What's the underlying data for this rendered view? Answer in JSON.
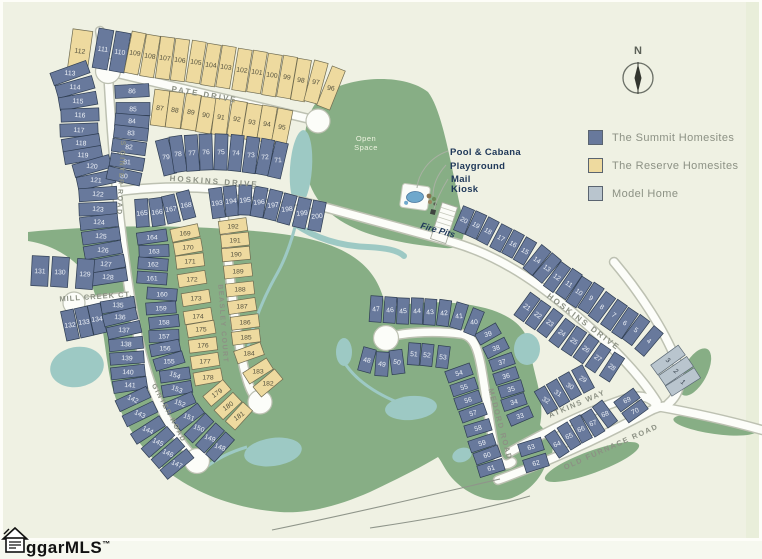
{
  "colors": {
    "bg": "#eff1e3",
    "page": "#fdfdf8",
    "edge_strip": "#e9eeda",
    "green": "#87ae85",
    "water": "#9dc9c4",
    "road_fill": "#fcfdf9",
    "road_casing": "#bdc1b2",
    "road_edge_line": "#8f958a",
    "summit": "#68799c",
    "summit_stroke": "#2e3d52",
    "reserve": "#eeda9f",
    "reserve_stroke": "#6f6b50",
    "model": "#b9c5ce",
    "model_stroke": "#5b6975",
    "num_summit": "#eef2f8",
    "num_reserve": "#55523f",
    "num_model": "#3c4752",
    "street_text": "#8c9184",
    "navy": "#20395a",
    "open_space_text": "#edf2df",
    "pool_water": "#6fa8cc"
  },
  "legend": {
    "items": [
      {
        "key": "summit",
        "label": "The Summit Homesites",
        "color": "#68799c"
      },
      {
        "key": "reserve",
        "label": "The Reserve Homesites",
        "color": "#eeda9f"
      },
      {
        "key": "model",
        "label": "Model Home",
        "color": "#b9c5ce"
      }
    ]
  },
  "compass": {
    "north_label": "N",
    "cx": 638,
    "cy": 78,
    "r": 15
  },
  "watermark": {
    "text": "ggarMLS",
    "tm": "™"
  },
  "open_space_label": {
    "line1": "Open",
    "line2": "Space",
    "x": 366,
    "y": 141
  },
  "amenity_labels": [
    {
      "text": "Pool & Cabana",
      "x": 450,
      "y": 155
    },
    {
      "text": "Playground",
      "x": 450,
      "y": 169
    },
    {
      "text": "Mail",
      "x": 451,
      "y": 182
    },
    {
      "text": "Kiosk",
      "x": 451,
      "y": 192
    }
  ],
  "fire_pits_label": {
    "text": "Fire Pits",
    "x": 437,
    "y": 233,
    "rot": 16
  },
  "street_labels": [
    {
      "text": "PATE DRIVE",
      "x": 204,
      "y": 97,
      "rot": 10,
      "size": 8,
      "ls": 2
    },
    {
      "text": "S GINTER ROAD",
      "x": 119,
      "y": 178,
      "rot": 93,
      "size": 7,
      "ls": 1.5
    },
    {
      "text": "HOSKINS DRIVE",
      "x": 214,
      "y": 184,
      "rot": 4,
      "size": 8,
      "ls": 2
    },
    {
      "text": "MILL CREEK CT.",
      "x": 96,
      "y": 299,
      "rot": -4,
      "size": 7.5,
      "ls": 1
    },
    {
      "text": "BEASLEY COURT",
      "x": 221,
      "y": 324,
      "rot": 86,
      "size": 7,
      "ls": 1.5
    },
    {
      "text": "GINTER ROAD",
      "x": 167,
      "y": 414,
      "rot": 62,
      "size": 7,
      "ls": 1.5
    },
    {
      "text": "HOSKINS DRIVE",
      "x": 582,
      "y": 324,
      "rot": 37,
      "size": 8,
      "ls": 2
    },
    {
      "text": "MEDORD ROAD",
      "x": 498,
      "y": 425,
      "rot": 75,
      "size": 7.5,
      "ls": 1.5
    },
    {
      "text": "ATKINS WAY",
      "x": 578,
      "y": 406,
      "rot": -23,
      "size": 7.5,
      "ls": 1.5
    },
    {
      "text": "OLD FURNACE ROAD",
      "x": 612,
      "y": 449,
      "rot": -24,
      "size": 7.5,
      "ls": 1.5
    }
  ],
  "lot_strips": [
    {
      "t": "R",
      "d": 42,
      "w": 20,
      "tr": 8,
      "a": 8,
      "n": [
        112
      ],
      "p": [
        [
          80,
          51
        ]
      ]
    },
    {
      "t": "S",
      "d": 40,
      "w": 15,
      "tr": 8,
      "n": [
        111,
        110
      ],
      "p": [
        [
          103,
          49
        ],
        [
          120,
          52
        ]
      ]
    },
    {
      "t": "R",
      "d": 42,
      "w": 14,
      "tr": 8,
      "n": [
        109,
        108,
        107,
        106,
        105,
        104,
        103,
        102,
        101,
        100,
        99,
        98,
        97,
        96
      ],
      "p": [
        [
          135,
          53
        ],
        [
          150,
          56
        ],
        [
          165,
          58
        ],
        [
          180,
          60
        ],
        [
          196,
          62
        ],
        [
          211,
          65
        ],
        [
          226,
          67
        ],
        [
          242,
          70
        ],
        [
          257,
          72
        ],
        [
          272,
          75
        ],
        [
          287,
          77
        ],
        [
          301,
          80
        ],
        [
          316,
          82
        ],
        [
          331,
          88
        ]
      ]
    },
    {
      "t": "R",
      "d": 36,
      "w": 15,
      "tr": 8,
      "n": [
        87,
        88,
        89,
        90,
        91,
        92,
        93,
        94,
        95
      ],
      "p": [
        [
          160,
          108
        ],
        [
          175,
          110
        ],
        [
          191,
          112
        ],
        [
          206,
          115
        ],
        [
          221,
          117
        ],
        [
          237,
          119
        ],
        [
          252,
          122
        ],
        [
          267,
          124
        ],
        [
          282,
          127
        ]
      ]
    },
    {
      "t": "S",
      "d": 38,
      "w": 13,
      "tr": 4,
      "n": [
        113,
        114,
        115,
        116,
        117,
        118,
        119
      ],
      "p": [
        [
          70,
          73
        ],
        [
          75,
          87
        ],
        [
          78,
          101
        ],
        [
          80,
          115
        ],
        [
          79,
          130
        ],
        [
          81,
          143
        ],
        [
          83,
          155
        ]
      ]
    },
    {
      "t": "S",
      "d": 38,
      "w": 13,
      "tr": 4,
      "n": [
        120,
        121,
        122,
        123,
        124,
        125,
        126,
        127,
        128
      ],
      "p": [
        [
          92,
          166
        ],
        [
          96,
          180
        ],
        [
          98,
          194
        ],
        [
          98,
          209
        ],
        [
          99,
          222
        ],
        [
          101,
          236
        ],
        [
          103,
          250
        ],
        [
          106,
          264
        ],
        [
          108,
          277
        ]
      ]
    },
    {
      "t": "S",
      "d": 30,
      "w": 17,
      "tr": 2,
      "n": [
        131,
        130,
        129
      ],
      "p": [
        [
          40,
          271
        ],
        [
          60,
          272
        ],
        [
          85,
          274
        ]
      ]
    },
    {
      "t": "S",
      "d": 30,
      "w": 13,
      "tr": -6,
      "n": [
        132,
        133,
        134
      ],
      "p": [
        [
          70,
          325
        ],
        [
          84,
          322
        ],
        [
          97,
          319
        ]
      ]
    },
    {
      "t": "S",
      "d": 34,
      "w": 12,
      "tr": 3,
      "n": [
        135,
        136,
        137,
        138,
        139,
        140,
        141
      ],
      "p": [
        [
          118,
          305
        ],
        [
          120,
          317
        ],
        [
          124,
          330
        ],
        [
          126,
          344
        ],
        [
          127,
          358
        ],
        [
          128,
          372
        ],
        [
          130,
          385
        ]
      ]
    },
    {
      "t": "S",
      "d": 34,
      "w": 12,
      "tr": 25,
      "n": [
        142,
        143,
        144,
        145,
        146,
        147
      ],
      "p": [
        [
          133,
          399
        ],
        [
          140,
          414
        ],
        [
          148,
          430
        ],
        [
          158,
          442
        ],
        [
          168,
          453
        ],
        [
          177,
          464
        ]
      ]
    },
    {
      "t": "S",
      "d": 34,
      "w": 13,
      "tr": 3,
      "n": [
        86,
        85,
        84,
        83,
        82,
        81,
        80
      ],
      "p": [
        [
          132,
          91
        ],
        [
          133,
          109
        ],
        [
          132,
          121
        ],
        [
          131,
          133
        ],
        [
          129,
          147
        ],
        [
          127,
          162
        ],
        [
          124,
          176
        ]
      ]
    },
    {
      "t": "S",
      "d": 36,
      "w": 13,
      "tr": -3,
      "n": [
        79,
        78,
        77,
        76,
        75,
        74,
        73,
        72,
        71
      ],
      "p": [
        [
          166,
          157
        ],
        [
          178,
          154
        ],
        [
          192,
          153
        ],
        [
          206,
          152
        ],
        [
          221,
          152
        ],
        [
          236,
          153
        ],
        [
          251,
          155
        ],
        [
          265,
          157
        ],
        [
          278,
          160
        ]
      ]
    },
    {
      "t": "S",
      "d": 28,
      "w": 13,
      "tr": -6,
      "n": [
        165,
        166,
        167,
        168
      ],
      "p": [
        [
          142,
          213
        ],
        [
          157,
          212
        ],
        [
          171,
          209
        ],
        [
          186,
          205
        ]
      ]
    },
    {
      "t": "S",
      "d": 30,
      "w": 12,
      "tr": 0,
      "n": [
        164,
        163,
        162,
        161
      ],
      "p": [
        [
          152,
          237
        ],
        [
          154,
          251
        ],
        [
          153,
          264
        ],
        [
          152,
          278
        ]
      ]
    },
    {
      "t": "S",
      "d": 30,
      "w": 12,
      "tr": 0,
      "n": [
        160,
        159,
        158,
        157,
        156,
        155
      ],
      "p": [
        [
          162,
          294
        ],
        [
          161,
          308
        ],
        [
          164,
          322
        ],
        [
          164,
          336
        ],
        [
          165,
          348
        ],
        [
          169,
          361
        ]
      ]
    },
    {
      "t": "S",
      "d": 30,
      "w": 12,
      "tr": 20,
      "n": [
        154,
        153,
        152,
        151,
        150,
        149,
        148
      ],
      "p": [
        [
          175,
          375
        ],
        [
          177,
          389
        ],
        [
          180,
          403
        ],
        [
          189,
          417
        ],
        [
          199,
          428
        ],
        [
          210,
          438
        ],
        [
          220,
          447
        ]
      ]
    },
    {
      "t": "R",
      "d": 28,
      "w": 13,
      "tr": 0,
      "n": [
        169,
        170,
        171,
        172,
        173,
        174,
        175,
        176,
        177,
        178
      ],
      "p": [
        [
          185,
          233
        ],
        [
          188,
          247
        ],
        [
          190,
          261
        ],
        [
          192,
          279
        ],
        [
          196,
          298
        ],
        [
          198,
          316
        ],
        [
          201,
          329
        ],
        [
          203,
          345
        ],
        [
          205,
          361
        ],
        [
          208,
          377
        ]
      ]
    },
    {
      "t": "R",
      "d": 26,
      "w": 13,
      "tr": -35,
      "n": [
        179,
        180,
        181
      ],
      "p": [
        [
          217,
          393
        ],
        [
          228,
          406
        ],
        [
          239,
          416
        ]
      ]
    },
    {
      "t": "R",
      "d": 28,
      "w": 13,
      "tr": 0,
      "n": [
        192,
        191,
        190,
        189,
        188,
        187,
        186,
        185,
        184,
        183,
        182
      ],
      "p": [
        [
          233,
          226
        ],
        [
          235,
          240
        ],
        [
          236,
          254
        ],
        [
          238,
          271
        ],
        [
          240,
          289
        ],
        [
          242,
          306
        ],
        [
          245,
          322
        ],
        [
          246,
          337
        ],
        [
          249,
          353
        ],
        [
          258,
          371
        ],
        [
          268,
          383
        ]
      ]
    },
    {
      "t": "S",
      "d": 30,
      "w": 13,
      "tr": -5,
      "n": [
        193,
        194,
        195,
        196,
        197,
        198,
        199,
        200
      ],
      "p": [
        [
          217,
          203
        ],
        [
          231,
          201
        ],
        [
          245,
          200
        ],
        [
          259,
          202
        ],
        [
          273,
          205
        ],
        [
          287,
          209
        ],
        [
          302,
          213
        ],
        [
          317,
          216
        ]
      ]
    },
    {
      "t": "S",
      "d": 26,
      "w": 12,
      "tr": 30,
      "n": [
        20,
        19,
        18,
        17,
        16,
        15
      ],
      "p": [
        [
          464,
          220
        ],
        [
          476,
          225
        ],
        [
          488,
          231
        ],
        [
          501,
          238
        ],
        [
          513,
          244
        ],
        [
          525,
          251
        ]
      ]
    },
    {
      "t": "S",
      "d": 30,
      "w": 12,
      "tr": 35,
      "n": [
        14,
        13,
        12,
        11,
        10,
        9,
        8,
        7,
        6,
        5,
        4
      ],
      "p": [
        [
          537,
          260
        ],
        [
          547,
          268
        ],
        [
          557,
          277
        ],
        [
          569,
          284
        ],
        [
          579,
          292
        ],
        [
          591,
          298
        ],
        [
          602,
          307
        ],
        [
          614,
          315
        ],
        [
          625,
          323
        ],
        [
          636,
          330
        ],
        [
          649,
          341
        ]
      ]
    },
    {
      "t": "M",
      "d": 34,
      "w": 12,
      "tr": 35,
      "n": [
        3,
        2,
        1
      ],
      "p": [
        [
          668,
          360
        ],
        [
          676,
          371
        ],
        [
          683,
          382
        ]
      ]
    },
    {
      "t": "S",
      "d": 28,
      "w": 12,
      "tr": 35,
      "n": [
        21,
        22,
        23,
        24,
        25,
        26,
        27,
        28
      ],
      "p": [
        [
          527,
          307
        ],
        [
          538,
          315
        ],
        [
          550,
          323
        ],
        [
          562,
          333
        ],
        [
          574,
          341
        ],
        [
          586,
          349
        ],
        [
          598,
          358
        ],
        [
          612,
          367
        ]
      ]
    },
    {
      "t": "S",
      "d": 26,
      "w": 12,
      "tr": 30,
      "n": [
        29,
        30,
        31,
        32
      ],
      "p": [
        [
          583,
          379
        ],
        [
          570,
          386
        ],
        [
          558,
          393
        ],
        [
          546,
          400
        ]
      ]
    },
    {
      "t": "S",
      "d": 24,
      "w": 12,
      "tr": -15,
      "n": [
        39,
        38,
        37,
        36,
        35,
        34,
        33
      ],
      "p": [
        [
          488,
          334
        ],
        [
          496,
          348
        ],
        [
          502,
          362
        ],
        [
          506,
          376
        ],
        [
          511,
          389
        ],
        [
          514,
          402
        ],
        [
          520,
          416
        ]
      ]
    },
    {
      "t": "S",
      "d": 26,
      "w": 12,
      "tr": -5,
      "n": [
        47,
        46,
        45,
        44,
        43,
        42,
        41,
        40
      ],
      "p": [
        [
          376,
          309
        ],
        [
          390,
          310
        ],
        [
          403,
          311
        ],
        [
          417,
          311
        ],
        [
          430,
          312
        ],
        [
          444,
          313
        ],
        [
          459,
          316
        ],
        [
          474,
          322
        ]
      ]
    },
    {
      "t": "S",
      "d": 24,
      "w": 13,
      "tr": 10,
      "n": [
        48,
        49,
        50
      ],
      "p": [
        [
          367,
          360
        ],
        [
          382,
          364
        ],
        [
          397,
          362
        ]
      ]
    },
    {
      "t": "S",
      "d": 22,
      "w": 12,
      "tr": 5,
      "n": [
        51,
        52,
        53
      ],
      "p": [
        [
          414,
          354
        ],
        [
          427,
          355
        ],
        [
          443,
          357
        ]
      ]
    },
    {
      "t": "S",
      "d": 26,
      "w": 12,
      "tr": -15,
      "n": [
        54,
        55,
        56,
        57,
        58,
        59,
        60,
        61
      ],
      "p": [
        [
          459,
          373
        ],
        [
          464,
          387
        ],
        [
          468,
          400
        ],
        [
          473,
          413
        ],
        [
          478,
          428
        ],
        [
          482,
          443
        ],
        [
          487,
          455
        ],
        [
          491,
          468
        ]
      ]
    },
    {
      "t": "S",
      "d": 24,
      "w": 13,
      "tr": -15,
      "n": [
        63,
        62
      ],
      "p": [
        [
          531,
          447
        ],
        [
          536,
          463
        ]
      ]
    },
    {
      "t": "S",
      "d": 26,
      "w": 12,
      "tr": -20,
      "n": [
        64,
        65,
        66,
        67,
        68
      ],
      "p": [
        [
          557,
          444
        ],
        [
          569,
          436
        ],
        [
          581,
          429
        ],
        [
          593,
          423
        ],
        [
          605,
          414
        ]
      ]
    },
    {
      "t": "S",
      "d": 24,
      "w": 12,
      "tr": -25,
      "n": [
        69,
        70
      ],
      "p": [
        [
          627,
          400
        ],
        [
          635,
          411
        ]
      ]
    }
  ]
}
